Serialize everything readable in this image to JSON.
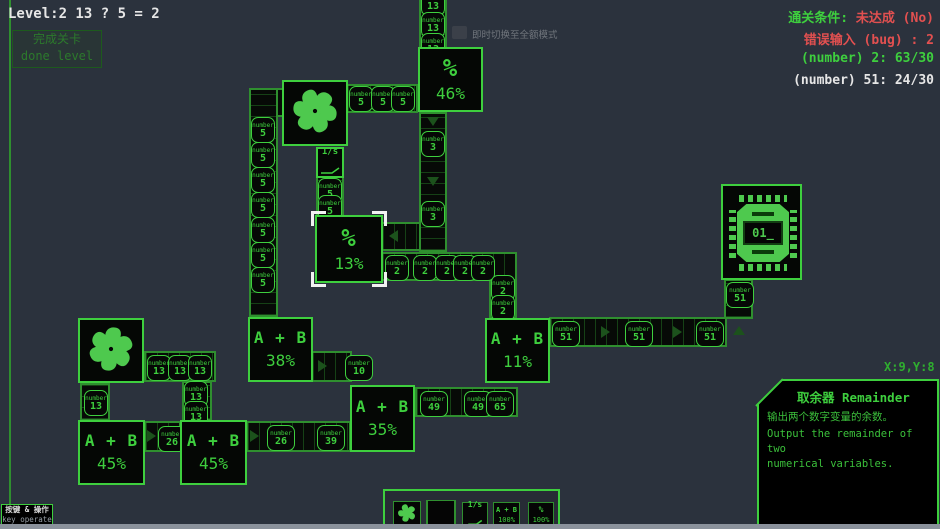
{
  "colors": {
    "accent": "#3ecf3e",
    "dim_green": "#1e5c1e",
    "red": "#e25050",
    "white": "#e8e8e8",
    "background": "#2b323d"
  },
  "hud": {
    "level": "Level:2 13 ? 5 = 2",
    "done_button": {
      "zh": "完成关卡",
      "en": "done level"
    },
    "stats": {
      "condition_label": "通关条件:",
      "condition_value": "未达成 (No)",
      "bug_line": "错误输入 (bug) : 2",
      "number2_line": "(number) 2: 63/30",
      "number51_line": "(number) 51: 24/30"
    },
    "tooltip": "即时切换至全额模式",
    "coords": "X:9,Y:8",
    "key_hint": {
      "zh": "按键 & 操作",
      "en": "key operate"
    }
  },
  "panel": {
    "title": "取余器 Remainder",
    "desc_zh": "输出两个数字变量的余数。",
    "desc_en_1": "Output the remainder of two",
    "desc_en_2": "numerical variables."
  },
  "board": {
    "token_label": "number",
    "tokens": [
      {
        "v": "13"
      },
      {
        "v": "13"
      },
      {
        "v": "13"
      },
      {
        "v": "5"
      },
      {
        "v": "5"
      },
      {
        "v": "5"
      },
      {
        "v": "5"
      },
      {
        "v": "5"
      },
      {
        "v": "5"
      },
      {
        "v": "5"
      },
      {
        "v": "5"
      },
      {
        "v": "5"
      },
      {
        "v": "5"
      },
      {
        "v": "5"
      },
      {
        "v": "5"
      },
      {
        "v": "3"
      },
      {
        "v": "3"
      },
      {
        "v": "2"
      },
      {
        "v": "2"
      },
      {
        "v": "2"
      },
      {
        "v": "2"
      },
      {
        "v": "2"
      },
      {
        "v": "2"
      },
      {
        "v": "2"
      },
      {
        "v": "49"
      },
      {
        "v": "49"
      },
      {
        "v": "65"
      },
      {
        "v": "10"
      },
      {
        "v": "26"
      },
      {
        "v": "26"
      },
      {
        "v": "39"
      },
      {
        "v": "13"
      },
      {
        "v": "13"
      },
      {
        "v": "13"
      },
      {
        "v": "13"
      },
      {
        "v": "13"
      },
      {
        "v": "13"
      },
      {
        "v": "51"
      },
      {
        "v": "51"
      },
      {
        "v": "51"
      },
      {
        "v": "51"
      }
    ],
    "blocks": {
      "mod46": {
        "sym": "%",
        "pct": "46%"
      },
      "mod13": {
        "sym": "%",
        "pct": "13%"
      },
      "add38": {
        "sym": "A + B",
        "pct": "38%"
      },
      "add11": {
        "sym": "A + B",
        "pct": "11%"
      },
      "add35": {
        "sym": "A + B",
        "pct": "35%"
      },
      "add45a": {
        "sym": "A + B",
        "pct": "45%"
      },
      "add45b": {
        "sym": "A + B",
        "pct": "45%"
      },
      "timer": {
        "label": "1/s"
      },
      "chip": {
        "display": "01_"
      }
    }
  },
  "toolbar": {
    "timer": "1/s",
    "add_top": "A + B",
    "add_bottom": "100%",
    "mod_top": "%",
    "mod_bottom": "100%"
  }
}
